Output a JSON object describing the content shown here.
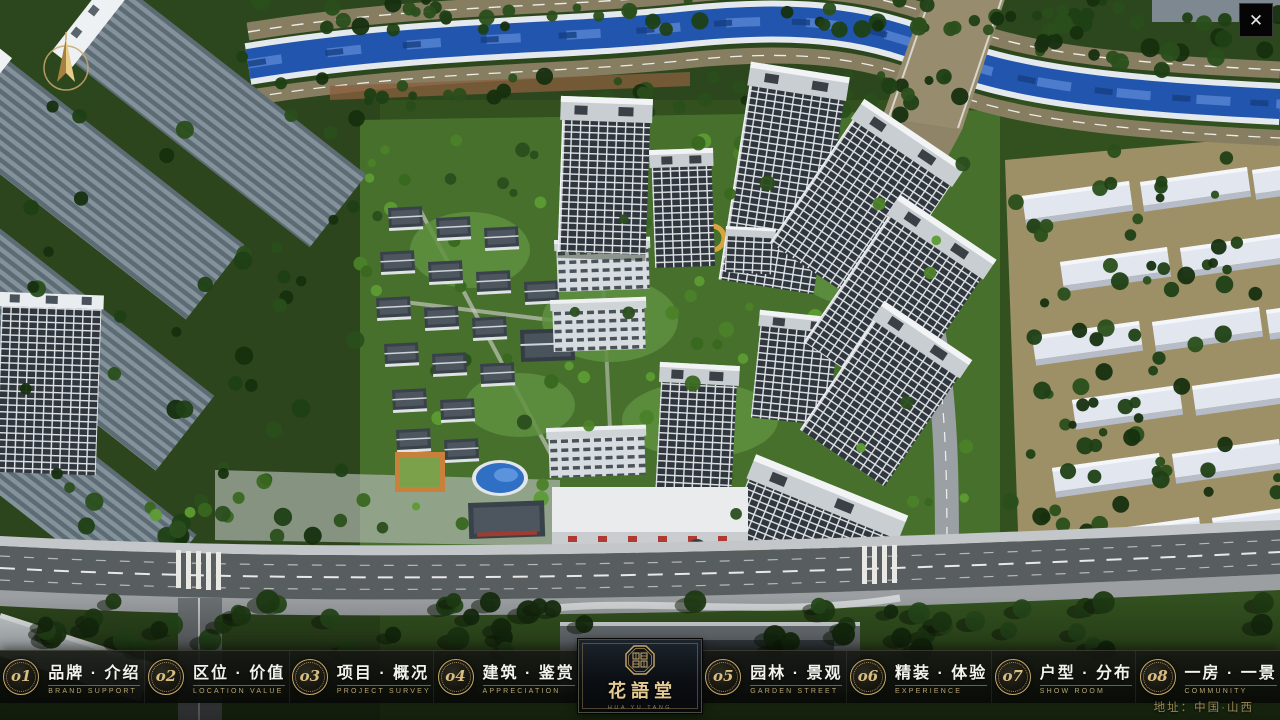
{
  "header": {
    "close_glyph": "✕"
  },
  "navbar": {
    "items": [
      {
        "num": "o1",
        "label": "品牌 · 介绍",
        "sub": "BRAND SUPPORT"
      },
      {
        "num": "o2",
        "label": "区位 · 价值",
        "sub": "LOCATION VALUE"
      },
      {
        "num": "o3",
        "label": "项目 · 概况",
        "sub": "PROJECT SURVEY"
      },
      {
        "num": "o4",
        "label": "建筑 · 鉴赏",
        "sub": "APPRECIATION"
      },
      {
        "num": "o5",
        "label": "园林 · 景观",
        "sub": "GARDEN STREET"
      },
      {
        "num": "o6",
        "label": "精装 · 体验",
        "sub": "EXPERIENCE"
      },
      {
        "num": "o7",
        "label": "户型 · 分布",
        "sub": "SHOW ROOM"
      },
      {
        "num": "o8",
        "label": "一房 · 一景",
        "sub": "COMMUNITY"
      }
    ],
    "logo": {
      "title": "花語堂",
      "subtitle": "HUA YU TANG"
    },
    "address": "地址：中国·山西"
  },
  "colors": {
    "gold_accent": "#c9a86b",
    "bar_background": "#0b0d09",
    "river_blue": "#2255ad",
    "foliage_green": "#335222",
    "tower_window": "#2f363d"
  }
}
